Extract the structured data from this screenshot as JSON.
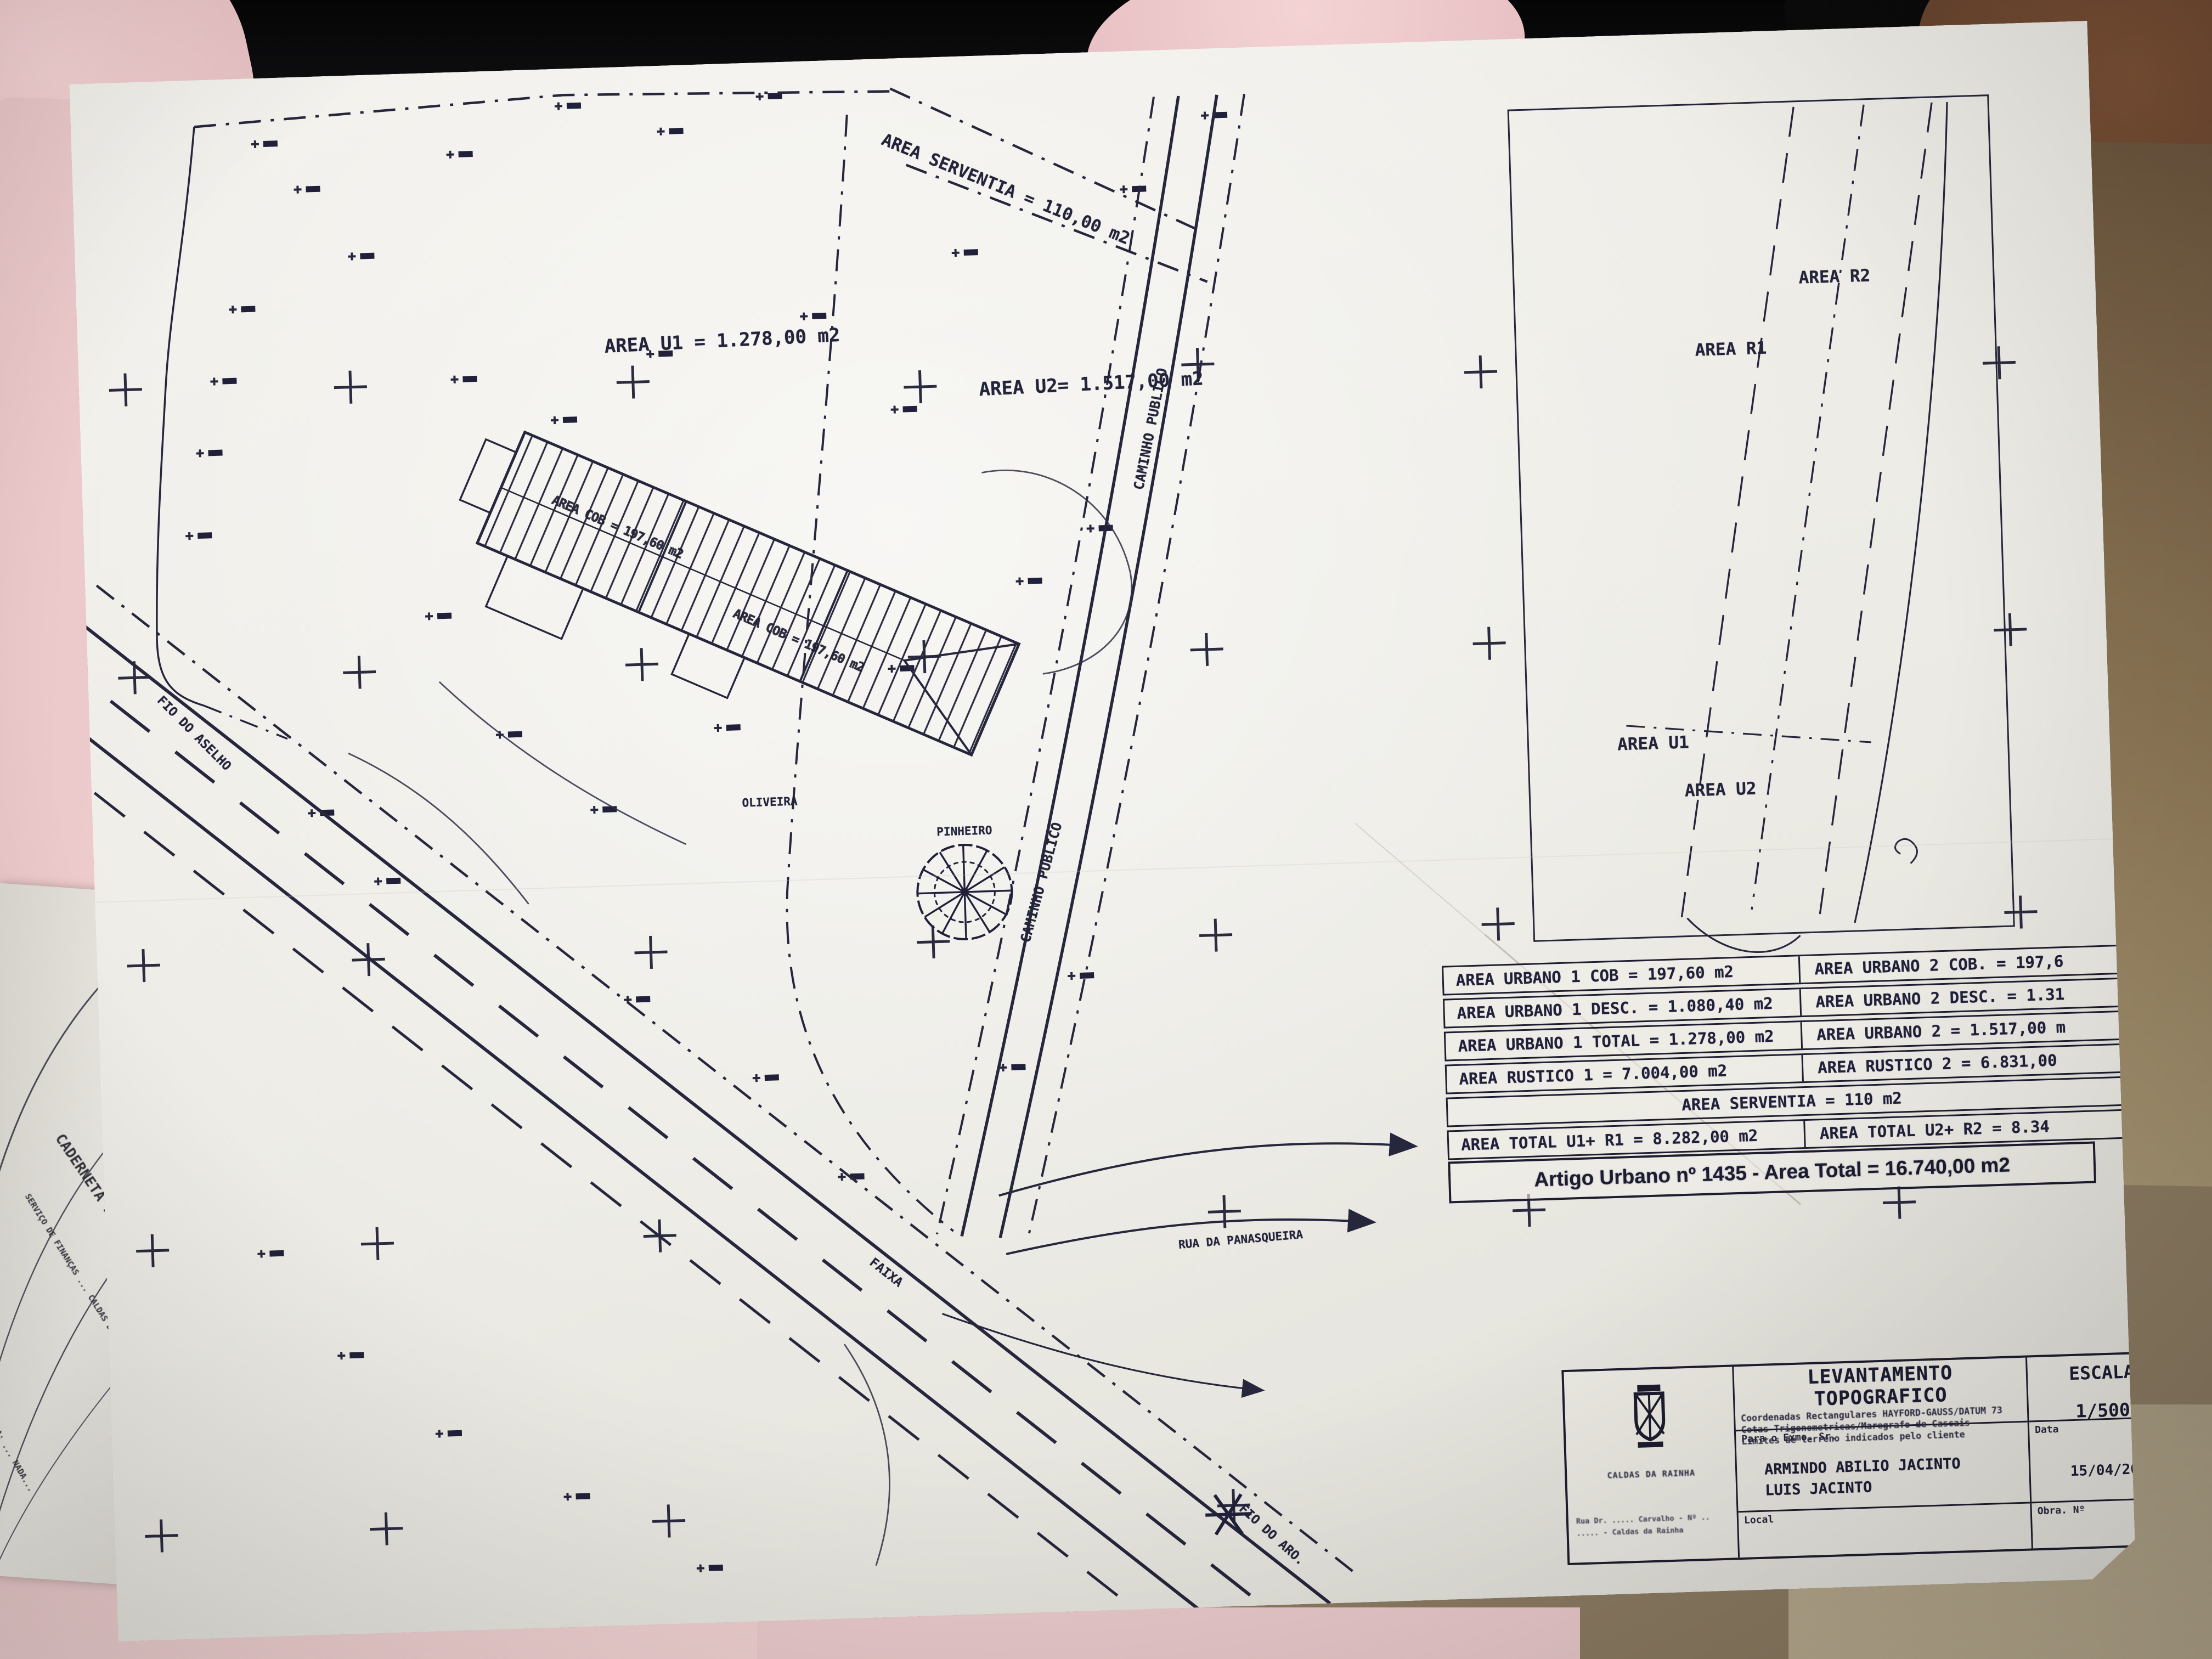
{
  "photo": {
    "colors": {
      "ink": "#23233a",
      "paper": "#efede7",
      "fabric_pink": "#eecccd",
      "laptop_black": "#0a0a0b",
      "carpet_brown": "#6e573f",
      "carpet_tan": "#b0a386"
    },
    "icons": {
      "crest": "municipal-crest-icon",
      "pine_tree": "pine-tree-plan-icon",
      "junction_star": "survey-star-icon",
      "registration_cross": "plus-cross-mark"
    }
  },
  "plan": {
    "labels": {
      "area_serventia": "AREA SERVENTIA = 110,00 m2",
      "area_u1": "AREA U1 = 1.278,00 m2",
      "area_u2": "AREA U2= 1.517,00 m2",
      "caminho_publico_1": "CAMINHO PUBLICO",
      "caminho_publico_2": "CAMINHO PUBLICO",
      "oliveira": "OLIVEIRA",
      "pinheiro": "PINHEIRO",
      "rua_da_panasqueira": "RUA DA PANASQUEIRA",
      "faixa": "FAIXA",
      "fio_do_aselho": "FIO DO ASELHO",
      "fio_do_aro": "FIO DO ARO.",
      "building_cob_1": "AREA COB = 197,60 m2",
      "building_cob_2": "AREA COB = 197,60 m2"
    },
    "inset": {
      "labels": [
        "AREA R2",
        "AREA R1",
        "AREA U1",
        "AREA U2"
      ]
    },
    "table": {
      "rows": [
        {
          "left": "AREA URBANO 1 COB = 197,60 m2",
          "right": "AREA URBANO 2 COB. = 197,6"
        },
        {
          "left": "AREA URBANO 1 DESC. = 1.080,40 m2",
          "right": "AREA URBANO 2 DESC. = 1.31"
        },
        {
          "left": "AREA URBANO 1 TOTAL = 1.278,00 m2",
          "right": "AREA URBANO 2 = 1.517,00 m"
        },
        {
          "left": "AREA RUSTICO 1 = 7.004,00 m2",
          "right": "AREA RUSTICO 2 = 6.831,00"
        },
        {
          "span": "AREA SERVENTIA = 110 m2"
        },
        {
          "left": "AREA TOTAL U1+ R1 = 8.282,00 m2",
          "right": "AREA TOTAL U2+ R2 = 8.34"
        }
      ],
      "total_row": "Artigo Urbano nº 1435 - Area Total = 16.740,00 m2"
    },
    "title_block": {
      "title": "LEVANTAMENTO TOPOGRAFICO",
      "subtitle_lines": [
        "Coordenadas Rectangulares HAYFORD-GAUSS/DATUM 73",
        "Cotas Trigonometricas/Maregrafo de Cascais",
        "Limites de terreno indicados pelo cliente"
      ],
      "escala_label": "ESCALA",
      "escala_value": "1/500",
      "client_label": "Para o Exmo. Sr.",
      "client_names": [
        "ARMINDO ABILIO JACINTO",
        "LUIS JACINTO"
      ],
      "data_label": "Data",
      "data_value": "15/04/20",
      "local_label": "Local",
      "obra_label": "Obra. Nº",
      "org_name": "CALDAS DA RAINHA",
      "address_lines": [
        "Rua Dr. ..... Carvalho - Nº ..",
        "..... - Caldas da Rainha"
      ]
    }
  },
  "under_document": {
    "lines": [
      "CADERNETA PREDIAL UR",
      "SERVIÇO DE FINANÇAS ... CALDAS DA RAINHA",
      "FREGUESIA: ... NADA..."
    ]
  }
}
